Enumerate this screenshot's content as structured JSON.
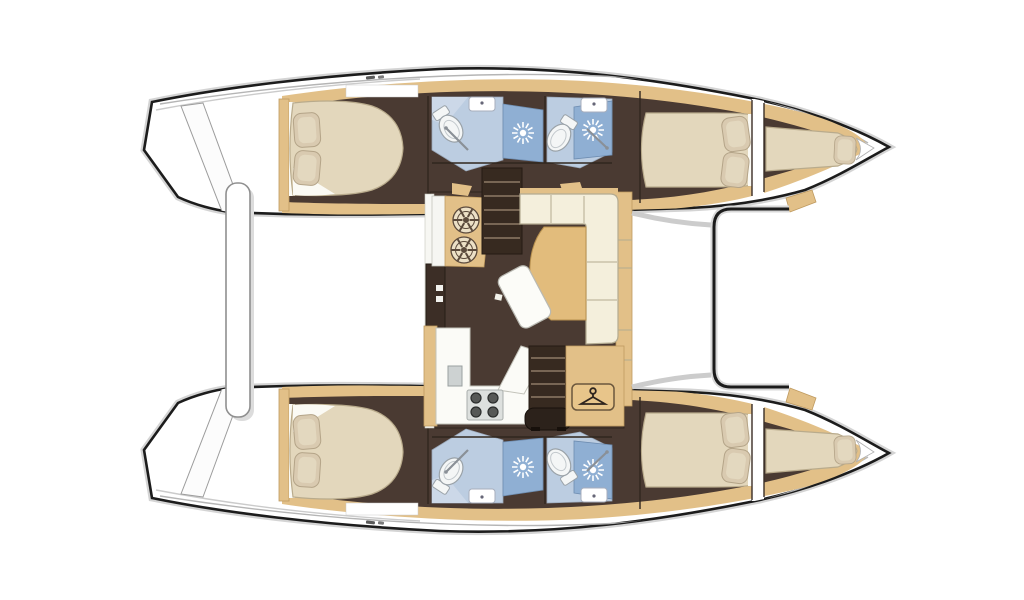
{
  "title": "Catamaran interior floor plan, overhead view",
  "colors": {
    "hull_outline": "#1c1c1c",
    "floor_brown": "#4a3a32",
    "wood_tan": "#e2c088",
    "wood_tan_dark": "#bf9a5f",
    "sofa_cream": "#f4efdc",
    "mattress_beige": "#e3d7bc",
    "pillow_beige": "#d9cab0",
    "bathroom_blue": "#bccde1",
    "shower_blue": "#8fafd3",
    "stair_brown": "#372a20",
    "stair_line": "#8d7a66",
    "table_tan": "#e2bc7c",
    "door_brown": "#3c2e26",
    "line_grey": "#b5b5b5"
  },
  "vessel": {
    "type": "catamaran",
    "view": "top-down interior layout plan",
    "orientation": {
      "bow": "right",
      "stern": "left"
    },
    "hulls": [
      {
        "side": "port",
        "position": "top",
        "spaces": [
          {
            "name": "aft double cabin",
            "furniture": [
              "island double berth",
              "2 pillows",
              "side wardrobe"
            ]
          },
          {
            "name": "aft bathroom",
            "fixtures": [
              "toilet",
              "washbasin",
              "shower cubicle"
            ]
          },
          {
            "name": "forward bathroom",
            "fixtures": [
              "toilet",
              "washbasin",
              "shower cubicle"
            ]
          },
          {
            "name": "forward double cabin",
            "furniture": [
              "double berth",
              "2 pillows"
            ]
          },
          {
            "name": "forepeak berth",
            "furniture": [
              "single berth",
              "1 pillow"
            ]
          }
        ]
      },
      {
        "side": "starboard",
        "position": "bottom",
        "spaces": [
          {
            "name": "aft double cabin",
            "furniture": [
              "island double berth",
              "2 pillows",
              "side wardrobe"
            ]
          },
          {
            "name": "aft bathroom",
            "fixtures": [
              "toilet",
              "washbasin",
              "shower cubicle"
            ]
          },
          {
            "name": "forward bathroom",
            "fixtures": [
              "toilet",
              "washbasin",
              "shower cubicle"
            ]
          },
          {
            "name": "forward double cabin",
            "furniture": [
              "double berth",
              "2 pillows"
            ]
          },
          {
            "name": "forepeak berth",
            "furniture": [
              "single berth",
              "1 pillow"
            ]
          }
        ]
      }
    ],
    "saloon": {
      "areas": [
        "galley",
        "dining area"
      ],
      "furniture": [
        "twin round galley sinks unit",
        "L-shaped sofa",
        "curved dining table",
        "freestanding lounge seat",
        "L-shaped galley counter",
        "4-burner stove",
        "galley sink",
        "wardrobe locker with hanger sign",
        "companionway stairs to port hull",
        "companionway stairs to starboard hull",
        "sliding door to aft cockpit"
      ]
    },
    "exterior": {
      "aft": [
        "transom steps on each hull",
        "cockpit bench"
      ],
      "forward": [
        "coachroof front coaming",
        "foredeck between bows"
      ]
    },
    "totals": {
      "double_cabins": 4,
      "bathrooms": 4,
      "toilets": 4,
      "showers": 4,
      "washbasins": 4,
      "forepeak_berths": 2
    }
  },
  "icons": [
    "shower-spray-icon",
    "round-sink-wheel-icon",
    "toilet-icon",
    "washbasin-icon",
    "stove-burners-icon",
    "hanger-icon"
  ]
}
